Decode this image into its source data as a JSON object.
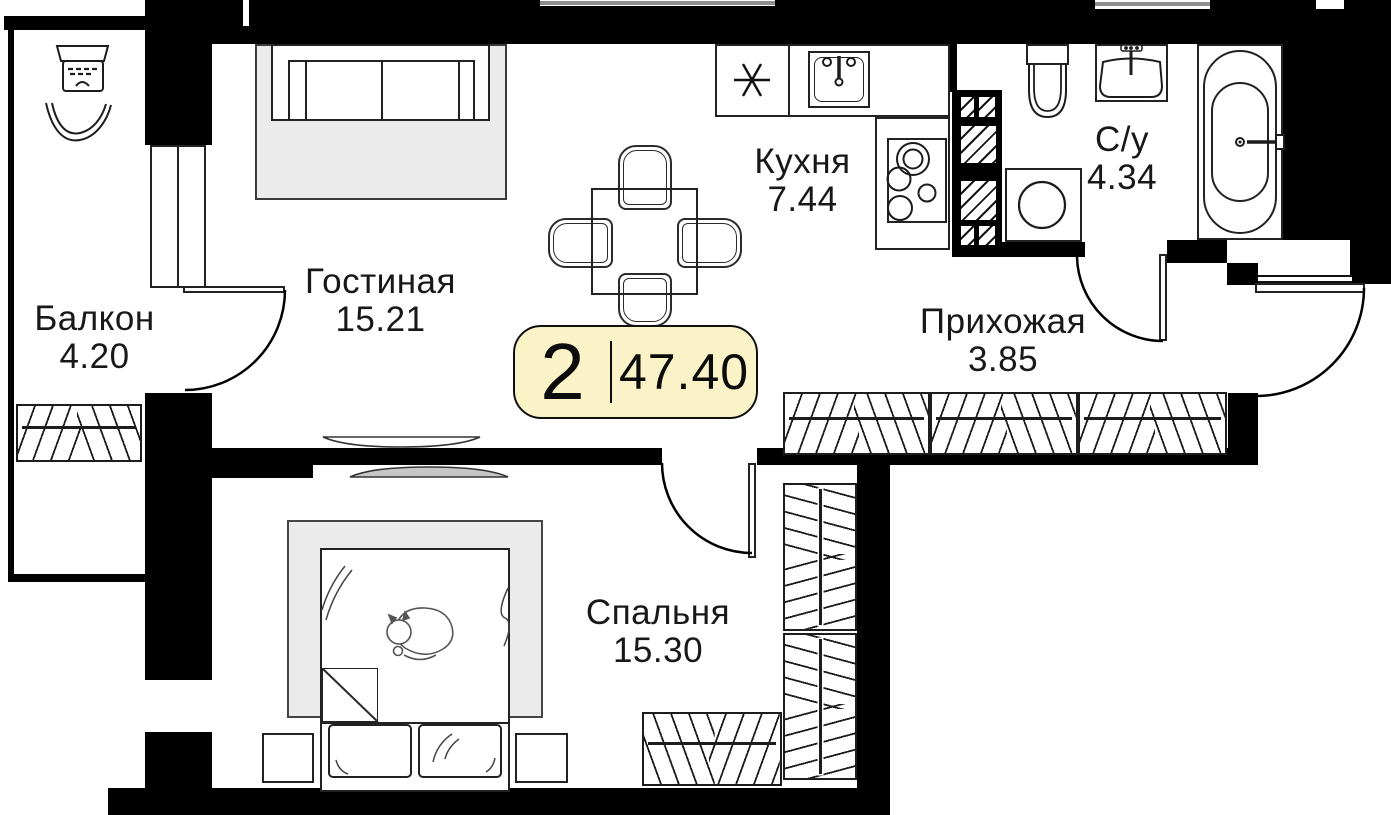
{
  "plan": {
    "title": "2-room apartment floor plan",
    "badge": {
      "rooms": "2",
      "area": "47.40"
    },
    "rooms": [
      {
        "name": "Балкон",
        "area": "4.20"
      },
      {
        "name": "Гостиная",
        "area": "15.21"
      },
      {
        "name": "Кухня",
        "area": "7.44"
      },
      {
        "name": "С/у",
        "area": "4.34"
      },
      {
        "name": "Прихожая",
        "area": "3.85"
      },
      {
        "name": "Спальня",
        "area": "15.30"
      }
    ],
    "colors": {
      "wall": "#000000",
      "badge_bg": "#FBF3C8",
      "badge_border": "#101010",
      "furniture_gray": "#EBEBEB"
    },
    "icons": [
      "ac-unit-icon",
      "sofa-icon",
      "dining-table-icon",
      "chair-icon",
      "fridge-star-icon",
      "kitchen-sink-icon",
      "stove-icon",
      "vent-shaft-icon",
      "toilet-icon",
      "bath-sink-icon",
      "washing-machine-icon",
      "bathtub-icon",
      "wardrobe-icon",
      "bed-icon",
      "cat-icon",
      "tv-icon",
      "door-arc-icon",
      "window-icon"
    ]
  }
}
